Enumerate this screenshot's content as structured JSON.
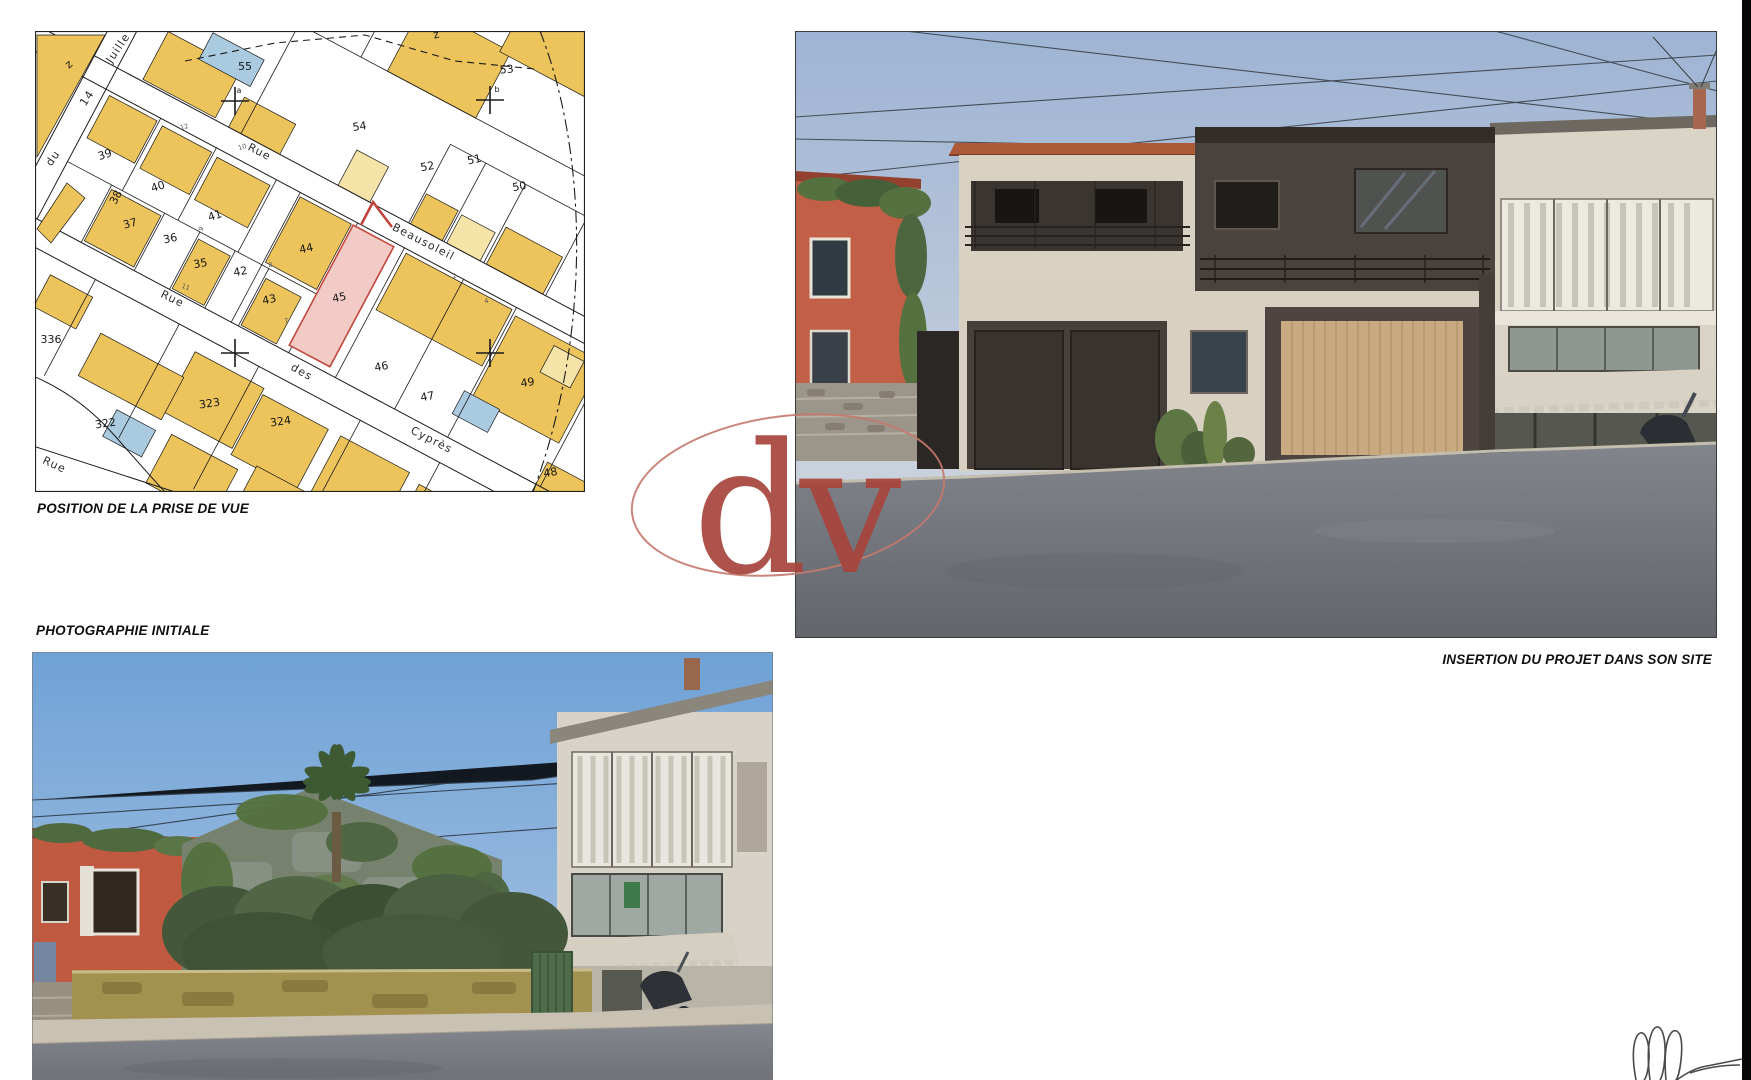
{
  "captions": {
    "map": "POSITION DE LA PRISE DE VUE",
    "photo": "PHOTOGRAPHIE INITIALE",
    "render": "INSERTION DU PROJET DANS SON SITE"
  },
  "watermark": {
    "text": "dv",
    "color": "#a8453c",
    "ellipse_color": "#c4796d"
  },
  "map": {
    "colors": {
      "building": "#edc45c",
      "building_light": "#f6e3a8",
      "building_blue": "#a9cadf",
      "parcel_line": "#1a1a1a",
      "highlight_fill": "#f3cbc6",
      "highlight_stroke": "#c2493d",
      "view_marker": "#c2403a"
    },
    "parcel_labels": [
      {
        "t": "z",
        "x": 36,
        "y": 36,
        "r": -40
      },
      {
        "t": "55",
        "x": 210,
        "y": 39,
        "r": 0
      },
      {
        "t": "53",
        "x": 472,
        "y": 42,
        "r": -5
      },
      {
        "t": "z",
        "x": 402,
        "y": 7,
        "r": -15
      },
      {
        "t": "54",
        "x": 325,
        "y": 99,
        "r": -8
      },
      {
        "t": "52",
        "x": 393,
        "y": 139,
        "r": -10
      },
      {
        "t": "51",
        "x": 440,
        "y": 132,
        "r": -12
      },
      {
        "t": "50",
        "x": 485,
        "y": 159,
        "r": -10
      },
      {
        "t": "39",
        "x": 71,
        "y": 127,
        "r": -18
      },
      {
        "t": "38",
        "x": 84,
        "y": 168,
        "r": -62
      },
      {
        "t": "37",
        "x": 96,
        "y": 196,
        "r": -15
      },
      {
        "t": "40",
        "x": 124,
        "y": 159,
        "r": -18
      },
      {
        "t": "36",
        "x": 136,
        "y": 211,
        "r": -12
      },
      {
        "t": "41",
        "x": 181,
        "y": 188,
        "r": -18
      },
      {
        "t": "35",
        "x": 166,
        "y": 236,
        "r": -10
      },
      {
        "t": "42",
        "x": 206,
        "y": 244,
        "r": -10
      },
      {
        "t": "43",
        "x": 235,
        "y": 272,
        "r": -12
      },
      {
        "t": "44",
        "x": 272,
        "y": 221,
        "r": -12
      },
      {
        "t": "45",
        "x": 305,
        "y": 270,
        "r": -12
      },
      {
        "t": "46",
        "x": 347,
        "y": 339,
        "r": -10
      },
      {
        "t": "47",
        "x": 393,
        "y": 369,
        "r": -10
      },
      {
        "t": "48",
        "x": 516,
        "y": 445,
        "r": -10
      },
      {
        "t": "49",
        "x": 493,
        "y": 355,
        "r": -8
      },
      {
        "t": "336",
        "x": 16,
        "y": 312,
        "r": 0
      },
      {
        "t": "322",
        "x": 71,
        "y": 396,
        "r": -8
      },
      {
        "t": "323",
        "x": 175,
        "y": 376,
        "r": -8
      },
      {
        "t": "324",
        "x": 246,
        "y": 394,
        "r": -8
      }
    ],
    "street_labels": [
      {
        "t": "Juille",
        "x": 86,
        "y": 19,
        "r": -56
      },
      {
        "t": "14",
        "x": 55,
        "y": 69,
        "r": -56
      },
      {
        "t": "du",
        "x": 21,
        "y": 129,
        "r": -56
      },
      {
        "t": "Rue",
        "x": 223,
        "y": 124,
        "r": 27
      },
      {
        "t": "Beausoleil",
        "x": 387,
        "y": 214,
        "r": 27
      },
      {
        "t": "Rue",
        "x": 136,
        "y": 271,
        "r": 26
      },
      {
        "t": "des",
        "x": 265,
        "y": 344,
        "r": 30
      },
      {
        "t": "Cyprès",
        "x": 395,
        "y": 412,
        "r": 27
      },
      {
        "t": "Rue",
        "x": 18,
        "y": 437,
        "r": 25
      }
    ],
    "ref_labels": [
      {
        "t": "a",
        "x": 204,
        "y": 62
      },
      {
        "t": "b",
        "x": 462,
        "y": 61
      }
    ],
    "tiny_labels": [
      {
        "t": "12",
        "x": 150,
        "y": 98,
        "r": -18
      },
      {
        "t": "10",
        "x": 208,
        "y": 118,
        "r": -18
      },
      {
        "t": "9",
        "x": 168,
        "y": 199,
        "r": -60
      },
      {
        "t": "11",
        "x": 150,
        "y": 258,
        "r": 20
      },
      {
        "t": "8",
        "x": 236,
        "y": 236,
        "r": -15
      },
      {
        "t": "7",
        "x": 252,
        "y": 292,
        "r": -15
      },
      {
        "t": "2",
        "x": 420,
        "y": 247,
        "r": -15
      },
      {
        "t": "4",
        "x": 452,
        "y": 272,
        "r": -15
      }
    ]
  }
}
